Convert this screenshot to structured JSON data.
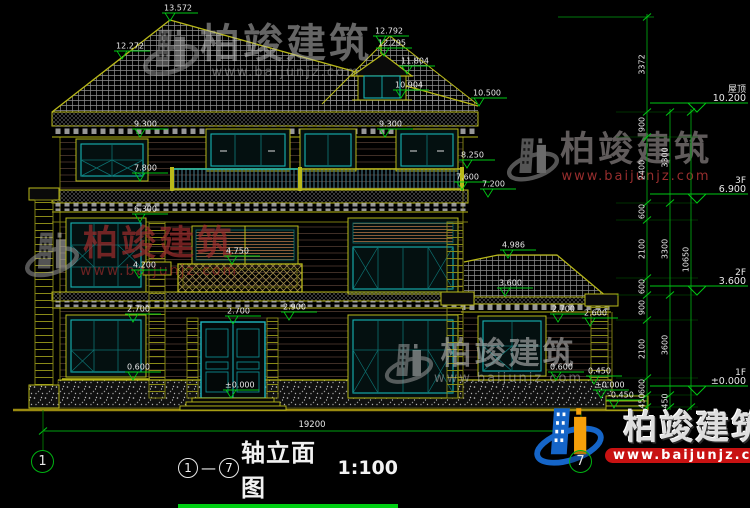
{
  "drawing": {
    "title": {
      "axis_start": "1",
      "dash": "—",
      "axis_end": "7",
      "name": "轴立面图",
      "scale": "1:100"
    },
    "axes": {
      "left": "1",
      "right": "7"
    },
    "overall_dim": "19200",
    "watermark": {
      "brand": "柏竣建筑",
      "url": "www.baijunjz.com"
    },
    "right_levels": [
      {
        "name": "屋顶",
        "value": "10.200",
        "y": 112
      },
      {
        "name": "3F",
        "value": "6.900",
        "y": 203
      },
      {
        "name": "2F",
        "value": "3.600",
        "y": 295
      },
      {
        "name": "1F",
        "value": "±0.000",
        "y": 395
      }
    ],
    "chains": [
      {
        "x": 647,
        "segments": [
          {
            "len": "3372",
            "y1": 17,
            "y2": 112
          },
          {
            "len": "900",
            "y1": 112,
            "y2": 137
          },
          {
            "len": "2400",
            "y1": 137,
            "y2": 203
          },
          {
            "len": "600",
            "y1": 203,
            "y2": 220
          },
          {
            "len": "2100",
            "y1": 220,
            "y2": 278
          },
          {
            "len": "600",
            "y1": 278,
            "y2": 295
          },
          {
            "len": "900",
            "y1": 295,
            "y2": 320
          },
          {
            "len": "2100",
            "y1": 320,
            "y2": 378
          },
          {
            "len": "600",
            "y1": 378,
            "y2": 395
          },
          {
            "len": "450",
            "y1": 395,
            "y2": 407
          }
        ]
      },
      {
        "x": 670,
        "segments": [
          {
            "len": "3300",
            "y1": 112,
            "y2": 203
          },
          {
            "len": "3300",
            "y1": 203,
            "y2": 295
          },
          {
            "len": "3600",
            "y1": 295,
            "y2": 395
          },
          {
            "len": "450",
            "y1": 395,
            "y2": 407
          }
        ]
      },
      {
        "x": 691,
        "segments": [
          {
            "len": "10650",
            "y1": 112,
            "y2": 407
          }
        ]
      }
    ],
    "spot_elevations": [
      {
        "text": "13.572",
        "x": 170,
        "y": 21
      },
      {
        "text": "12.272",
        "x": 122,
        "y": 59
      },
      {
        "text": "12.792",
        "x": 381,
        "y": 44
      },
      {
        "text": "12.295",
        "x": 384,
        "y": 56
      },
      {
        "text": "11.804",
        "x": 407,
        "y": 74
      },
      {
        "text": "10.904",
        "x": 401,
        "y": 98
      },
      {
        "text": "10.500",
        "x": 479,
        "y": 106
      },
      {
        "text": "9.300",
        "x": 140,
        "y": 137
      },
      {
        "text": "9.300",
        "x": 385,
        "y": 137
      },
      {
        "text": "8.250",
        "x": 467,
        "y": 168
      },
      {
        "text": "7.800",
        "x": 140,
        "y": 181
      },
      {
        "text": "7.600",
        "x": 462,
        "y": 190
      },
      {
        "text": "7.200",
        "x": 488,
        "y": 197
      },
      {
        "text": "6.300",
        "x": 140,
        "y": 222
      },
      {
        "text": "4.986",
        "x": 508,
        "y": 258
      },
      {
        "text": "4.750",
        "x": 232,
        "y": 264
      },
      {
        "text": "4.200",
        "x": 139,
        "y": 278
      },
      {
        "text": "3.600",
        "x": 505,
        "y": 296
      },
      {
        "text": "2.900",
        "x": 289,
        "y": 320
      },
      {
        "text": "2.700",
        "x": 133,
        "y": 322
      },
      {
        "text": "2.700",
        "x": 233,
        "y": 324
      },
      {
        "text": "2.700",
        "x": 558,
        "y": 322
      },
      {
        "text": "2.600",
        "x": 590,
        "y": 326
      },
      {
        "text": "0.600",
        "x": 133,
        "y": 380
      },
      {
        "text": "0.600",
        "x": 556,
        "y": 380
      },
      {
        "text": "0.450",
        "x": 594,
        "y": 384
      },
      {
        "text": "±0.000",
        "x": 231,
        "y": 398
      },
      {
        "text": "±0.000",
        "x": 601,
        "y": 398
      },
      {
        "text": "-0.450",
        "x": 614,
        "y": 408
      }
    ],
    "ext_lines_y": [
      112,
      137,
      203,
      220,
      278,
      295,
      320,
      378,
      395,
      407
    ],
    "colors": {
      "dim_green": "#00c814",
      "line_yellow": "#b9b919",
      "teal": "#17b3b3",
      "text_white": "#e8e8e8",
      "logo_red": "#c81212",
      "logo_blue": "#1565c8",
      "logo_orange": "#f59f0a"
    }
  }
}
